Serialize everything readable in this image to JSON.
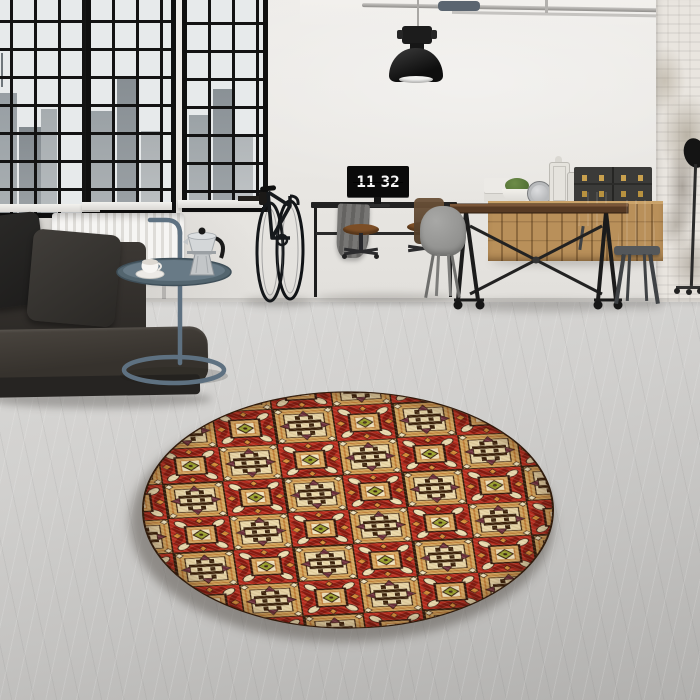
{
  "meta": {
    "description": "Photograph of an industrial loft interior: black-framed factory windows with a city view, dark leather sofa, blue-grey tray side table with moka pot, wall-mounted bicycle, desk with a monitor showing a flip clock, wood and iron dining table with metal chairs, oak sideboard with trunks and lanterns, pendant lamp, and a round red-and-tan patterned rug on a polished concrete floor.",
    "image_type": "interior product photo"
  },
  "monitor": {
    "hours": "11",
    "minutes": "32"
  },
  "colors": {
    "wall": "#e9e7e3",
    "floor": "#cbcac8",
    "window_frame": "#121212",
    "sofa_leather": "#37322d",
    "side_table": "#5e7181",
    "desk_metal": "#1f1f1f",
    "table_wood": "#563a24",
    "sideboard_wood": "#b9905a",
    "trunk_brass": "#c9a14e",
    "rug_red": "#bb2d1e",
    "rug_tan": "#d4a75d",
    "rug_cream": "#eedfb2",
    "rug_olive": "#9aa22c",
    "rug_maroon": "#6d2f3c",
    "rug_outline": "#2e1a0a"
  },
  "rug": {
    "shape": "round",
    "pattern": "checkerboard patchwork of square tiles",
    "tiles": [
      "tan tile with dark hash motif, maroon arrowheads and cream corner diamonds",
      "red tile with gold square medallion, olive-green diamond centre and cream corner petals"
    ]
  },
  "objects": [
    "factory windows with city view",
    "white radiator",
    "dark leather sofa with cushions",
    "blue-grey tray side table",
    "moka pot",
    "coffee cup",
    "black bicycle on wall mount",
    "wall desk with monitor flip clock",
    "grey draped cloth",
    "wooden office stools",
    "industrial pendant lamp",
    "ceiling conduit pipes",
    "wood and iron dining table on casters",
    "grey shell chair",
    "gunmetal metal chairs",
    "oak sideboard",
    "white box stack",
    "potted plant",
    "silver table clock",
    "white lanterns",
    "black storage trunks with brass clasps",
    "whitewashed brick column",
    "studio lamp on casters",
    "round patterned rug",
    "polished concrete floor"
  ]
}
